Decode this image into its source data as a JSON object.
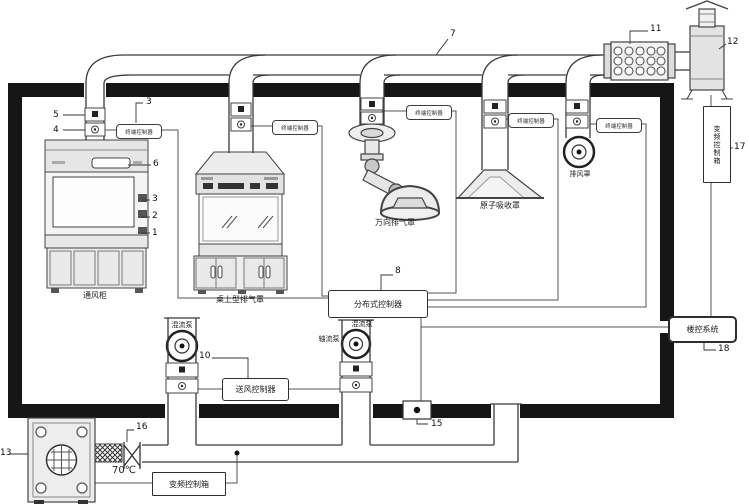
{
  "diagram": {
    "kind": "laboratory-ventilation-system-schematic",
    "line_color": "#3a3a3a",
    "wall_color": "#161616",
    "background": "#ffffff"
  },
  "callouts": {
    "n1": "1",
    "n2": "2",
    "n3a": "3",
    "n3b": "3",
    "n4": "4",
    "n5": "5",
    "n6": "6",
    "n7": "7",
    "n8": "8",
    "n10": "10",
    "n11": "11",
    "n12": "12",
    "n13": "13",
    "n15": "15",
    "n16": "16",
    "n17": "17",
    "n18": "18"
  },
  "labels": {
    "fume_hood": "通风柜",
    "bench_hood": "桌上型排气罩",
    "universal_hood": "万向排气罩",
    "canopy_hood": "原子吸收罩",
    "exhaust_grille": "排风罩",
    "supply_fan_left": "混流泵",
    "supply_fan_center": "混流泵",
    "supply_fan_center_side": "轴流泵",
    "fire_damper_temp": "70℃"
  },
  "controllers": {
    "terminal": "终端控制器",
    "distributed": "分布式控制器",
    "supply": "送风控制器",
    "vfd": "变频控制箱",
    "vfd_vertical": "变频控制箱",
    "building": "楼控系统"
  }
}
